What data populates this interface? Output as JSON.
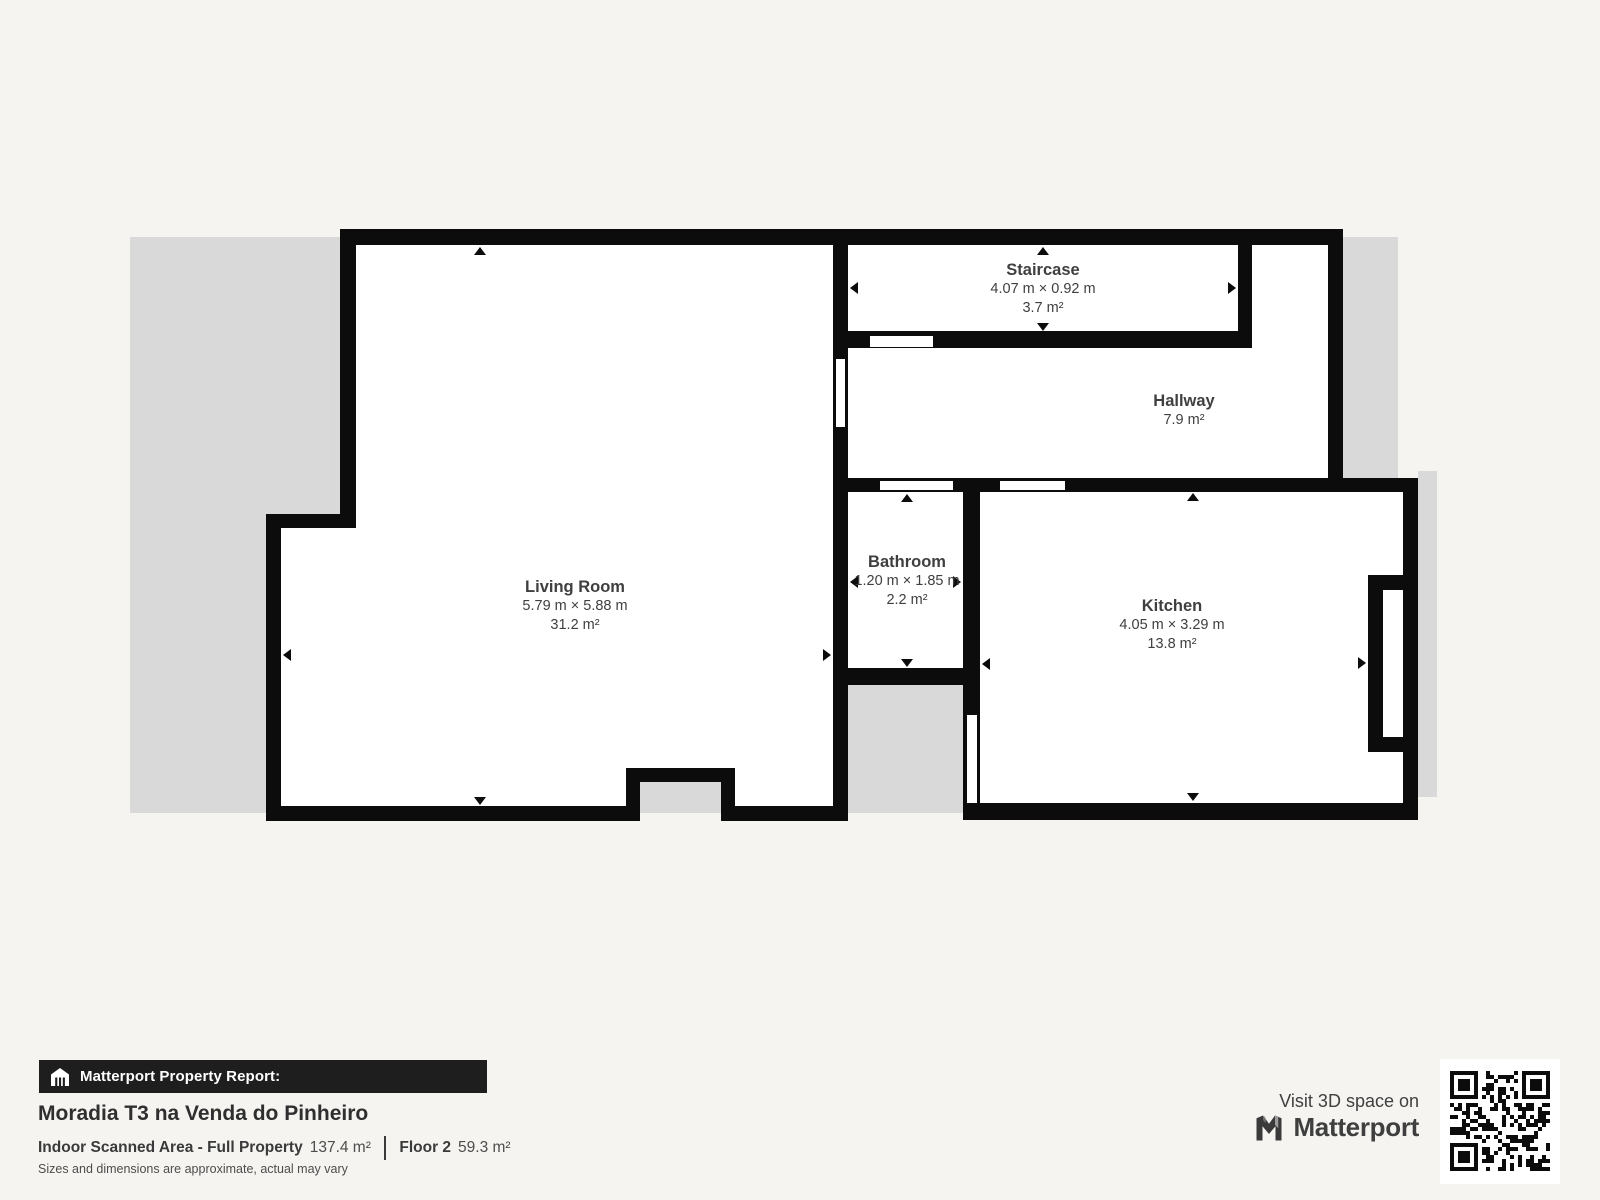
{
  "rooms": {
    "living_room": {
      "name": "Living Room",
      "dimensions": "5.79 m × 5.88 m",
      "area": "31.2 m²"
    },
    "staircase": {
      "name": "Staircase",
      "dimensions": "4.07 m × 0.92 m",
      "area": "3.7 m²"
    },
    "hallway": {
      "name": "Hallway",
      "area": "7.9 m²"
    },
    "bathroom": {
      "name": "Bathroom",
      "dimensions": "1.20 m × 1.85 m",
      "area": "2.2 m²"
    },
    "kitchen": {
      "name": "Kitchen",
      "dimensions": "4.05 m × 3.29 m",
      "area": "13.8 m²"
    }
  },
  "footer": {
    "report_label": "Matterport Property Report:",
    "property_title": "Moradia T3 na Venda do Pinheiro",
    "scanned_area_label": "Indoor Scanned Area - Full Property",
    "scanned_area_value": "137.4 m²",
    "floor_label": "Floor 2",
    "floor_value": "59.3 m²",
    "disclaimer": "Sizes and dimensions are approximate, actual may vary"
  },
  "branding": {
    "visit_text": "Visit 3D space on",
    "brand_name": "Matterport"
  },
  "colors": {
    "background": "#f5f4f1",
    "backdrop_gray": "#d9d9d9",
    "wall_black": "#0c0c0c",
    "room_white": "#ffffff",
    "label_text": "#3f3f3f",
    "banner_black": "#1e1e1e"
  }
}
